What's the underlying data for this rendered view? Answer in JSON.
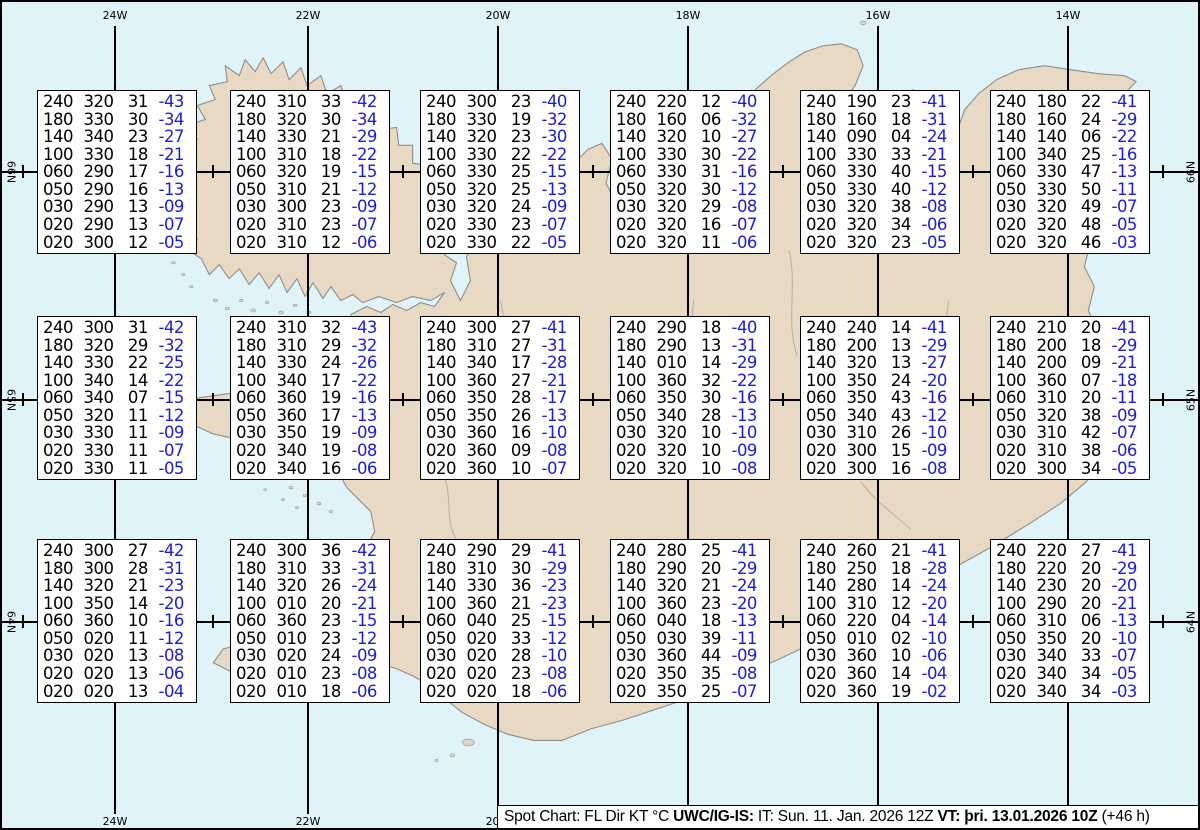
{
  "graticule": {
    "meridians": [
      {
        "label": "24W",
        "x": 113
      },
      {
        "label": "22W",
        "x": 306
      },
      {
        "label": "20W",
        "x": 496
      },
      {
        "label": "18W",
        "x": 686
      },
      {
        "label": "16W",
        "x": 876
      },
      {
        "label": "14W",
        "x": 1066
      }
    ],
    "parallels": [
      {
        "label": "66N",
        "y": 170
      },
      {
        "label": "65N",
        "y": 398
      },
      {
        "label": "64N",
        "y": 620
      }
    ],
    "minor_tick_x": [
      21,
      211,
      401,
      591,
      781,
      971,
      1161
    ]
  },
  "colors": {
    "ocean": "#dff3f8",
    "land": "#e8d9c5",
    "coastline": "#8e8e88",
    "temperature_text": "#1c1cdb",
    "graticule": "#000000"
  },
  "boxes": [
    {
      "row": 0,
      "col": 0,
      "lines": [
        [
          "240",
          "320",
          "31",
          "-43"
        ],
        [
          "180",
          "330",
          "30",
          "-34"
        ],
        [
          "140",
          "340",
          "23",
          "-27"
        ],
        [
          "100",
          "330",
          "18",
          "-21"
        ],
        [
          "060",
          "290",
          "17",
          "-16"
        ],
        [
          "050",
          "290",
          "16",
          "-13"
        ],
        [
          "030",
          "290",
          "13",
          "-09"
        ],
        [
          "020",
          "290",
          "13",
          "-07"
        ],
        [
          "020",
          "300",
          "12",
          "-05"
        ]
      ]
    },
    {
      "row": 0,
      "col": 1,
      "lines": [
        [
          "240",
          "310",
          "33",
          "-42"
        ],
        [
          "180",
          "320",
          "30",
          "-34"
        ],
        [
          "140",
          "330",
          "21",
          "-29"
        ],
        [
          "100",
          "310",
          "18",
          "-22"
        ],
        [
          "060",
          "320",
          "19",
          "-15"
        ],
        [
          "050",
          "310",
          "21",
          "-12"
        ],
        [
          "030",
          "300",
          "23",
          "-09"
        ],
        [
          "020",
          "310",
          "23",
          "-07"
        ],
        [
          "020",
          "310",
          "12",
          "-06"
        ]
      ]
    },
    {
      "row": 0,
      "col": 2,
      "lines": [
        [
          "240",
          "300",
          "23",
          "-40"
        ],
        [
          "180",
          "330",
          "19",
          "-32"
        ],
        [
          "140",
          "320",
          "23",
          "-30"
        ],
        [
          "100",
          "330",
          "22",
          "-22"
        ],
        [
          "060",
          "330",
          "25",
          "-15"
        ],
        [
          "050",
          "320",
          "25",
          "-13"
        ],
        [
          "030",
          "320",
          "24",
          "-09"
        ],
        [
          "020",
          "330",
          "23",
          "-07"
        ],
        [
          "020",
          "330",
          "22",
          "-05"
        ]
      ]
    },
    {
      "row": 0,
      "col": 3,
      "lines": [
        [
          "240",
          "220",
          "12",
          "-40"
        ],
        [
          "180",
          "160",
          "06",
          "-32"
        ],
        [
          "140",
          "320",
          "10",
          "-27"
        ],
        [
          "100",
          "330",
          "30",
          "-22"
        ],
        [
          "060",
          "330",
          "31",
          "-16"
        ],
        [
          "050",
          "320",
          "30",
          "-12"
        ],
        [
          "030",
          "320",
          "29",
          "-08"
        ],
        [
          "020",
          "320",
          "16",
          "-07"
        ],
        [
          "020",
          "320",
          "11",
          "-06"
        ]
      ]
    },
    {
      "row": 0,
      "col": 4,
      "lines": [
        [
          "240",
          "190",
          "23",
          "-41"
        ],
        [
          "180",
          "160",
          "18",
          "-31"
        ],
        [
          "140",
          "090",
          "04",
          "-24"
        ],
        [
          "100",
          "330",
          "33",
          "-21"
        ],
        [
          "060",
          "330",
          "40",
          "-15"
        ],
        [
          "050",
          "330",
          "40",
          "-12"
        ],
        [
          "030",
          "320",
          "38",
          "-08"
        ],
        [
          "020",
          "320",
          "34",
          "-06"
        ],
        [
          "020",
          "320",
          "23",
          "-05"
        ]
      ]
    },
    {
      "row": 0,
      "col": 5,
      "lines": [
        [
          "240",
          "180",
          "22",
          "-41"
        ],
        [
          "180",
          "160",
          "24",
          "-29"
        ],
        [
          "140",
          "140",
          "06",
          "-22"
        ],
        [
          "100",
          "340",
          "25",
          "-16"
        ],
        [
          "060",
          "330",
          "47",
          "-13"
        ],
        [
          "050",
          "330",
          "50",
          "-11"
        ],
        [
          "030",
          "320",
          "49",
          "-07"
        ],
        [
          "020",
          "320",
          "48",
          "-05"
        ],
        [
          "020",
          "320",
          "46",
          "-03"
        ]
      ]
    },
    {
      "row": 1,
      "col": 0,
      "lines": [
        [
          "240",
          "300",
          "31",
          "-42"
        ],
        [
          "180",
          "320",
          "29",
          "-32"
        ],
        [
          "140",
          "330",
          "22",
          "-25"
        ],
        [
          "100",
          "340",
          "14",
          "-22"
        ],
        [
          "060",
          "340",
          "07",
          "-15"
        ],
        [
          "050",
          "320",
          "11",
          "-12"
        ],
        [
          "030",
          "330",
          "11",
          "-09"
        ],
        [
          "020",
          "330",
          "11",
          "-07"
        ],
        [
          "020",
          "330",
          "11",
          "-05"
        ]
      ]
    },
    {
      "row": 1,
      "col": 1,
      "lines": [
        [
          "240",
          "310",
          "32",
          "-43"
        ],
        [
          "180",
          "310",
          "29",
          "-32"
        ],
        [
          "140",
          "330",
          "24",
          "-26"
        ],
        [
          "100",
          "340",
          "17",
          "-22"
        ],
        [
          "060",
          "360",
          "19",
          "-16"
        ],
        [
          "050",
          "360",
          "17",
          "-13"
        ],
        [
          "030",
          "350",
          "19",
          "-09"
        ],
        [
          "020",
          "340",
          "19",
          "-08"
        ],
        [
          "020",
          "340",
          "16",
          "-06"
        ]
      ]
    },
    {
      "row": 1,
      "col": 2,
      "lines": [
        [
          "240",
          "300",
          "27",
          "-41"
        ],
        [
          "180",
          "310",
          "27",
          "-31"
        ],
        [
          "140",
          "340",
          "17",
          "-28"
        ],
        [
          "100",
          "360",
          "27",
          "-21"
        ],
        [
          "060",
          "350",
          "28",
          "-17"
        ],
        [
          "050",
          "350",
          "26",
          "-13"
        ],
        [
          "030",
          "360",
          "16",
          "-10"
        ],
        [
          "020",
          "360",
          "09",
          "-08"
        ],
        [
          "020",
          "360",
          "10",
          "-07"
        ]
      ]
    },
    {
      "row": 1,
      "col": 3,
      "lines": [
        [
          "240",
          "290",
          "18",
          "-40"
        ],
        [
          "180",
          "290",
          "13",
          "-31"
        ],
        [
          "140",
          "010",
          "14",
          "-29"
        ],
        [
          "100",
          "360",
          "32",
          "-22"
        ],
        [
          "060",
          "350",
          "30",
          "-16"
        ],
        [
          "050",
          "340",
          "28",
          "-13"
        ],
        [
          "030",
          "320",
          "10",
          "-10"
        ],
        [
          "020",
          "320",
          "10",
          "-09"
        ],
        [
          "020",
          "320",
          "10",
          "-08"
        ]
      ]
    },
    {
      "row": 1,
      "col": 4,
      "lines": [
        [
          "240",
          "240",
          "14",
          "-41"
        ],
        [
          "180",
          "200",
          "13",
          "-29"
        ],
        [
          "140",
          "320",
          "13",
          "-27"
        ],
        [
          "100",
          "350",
          "24",
          "-20"
        ],
        [
          "060",
          "350",
          "43",
          "-16"
        ],
        [
          "050",
          "340",
          "43",
          "-12"
        ],
        [
          "030",
          "310",
          "26",
          "-10"
        ],
        [
          "020",
          "300",
          "15",
          "-09"
        ],
        [
          "020",
          "300",
          "16",
          "-08"
        ]
      ]
    },
    {
      "row": 1,
      "col": 5,
      "lines": [
        [
          "240",
          "210",
          "20",
          "-41"
        ],
        [
          "180",
          "200",
          "18",
          "-29"
        ],
        [
          "140",
          "200",
          "09",
          "-21"
        ],
        [
          "100",
          "360",
          "07",
          "-18"
        ],
        [
          "060",
          "310",
          "20",
          "-11"
        ],
        [
          "050",
          "320",
          "38",
          "-09"
        ],
        [
          "030",
          "310",
          "42",
          "-07"
        ],
        [
          "020",
          "310",
          "38",
          "-06"
        ],
        [
          "020",
          "300",
          "34",
          "-05"
        ]
      ]
    },
    {
      "row": 2,
      "col": 0,
      "lines": [
        [
          "240",
          "300",
          "27",
          "-42"
        ],
        [
          "180",
          "300",
          "28",
          "-31"
        ],
        [
          "140",
          "320",
          "21",
          "-23"
        ],
        [
          "100",
          "350",
          "14",
          "-20"
        ],
        [
          "060",
          "360",
          "10",
          "-16"
        ],
        [
          "050",
          "020",
          "11",
          "-12"
        ],
        [
          "030",
          "020",
          "13",
          "-08"
        ],
        [
          "020",
          "020",
          "13",
          "-06"
        ],
        [
          "020",
          "020",
          "13",
          "-04"
        ]
      ]
    },
    {
      "row": 2,
      "col": 1,
      "lines": [
        [
          "240",
          "300",
          "36",
          "-42"
        ],
        [
          "180",
          "310",
          "33",
          "-31"
        ],
        [
          "140",
          "320",
          "26",
          "-24"
        ],
        [
          "100",
          "010",
          "20",
          "-21"
        ],
        [
          "060",
          "360",
          "23",
          "-15"
        ],
        [
          "050",
          "010",
          "23",
          "-12"
        ],
        [
          "030",
          "020",
          "24",
          "-09"
        ],
        [
          "020",
          "010",
          "23",
          "-08"
        ],
        [
          "020",
          "010",
          "18",
          "-06"
        ]
      ]
    },
    {
      "row": 2,
      "col": 2,
      "lines": [
        [
          "240",
          "290",
          "29",
          "-41"
        ],
        [
          "180",
          "310",
          "30",
          "-29"
        ],
        [
          "140",
          "330",
          "36",
          "-23"
        ],
        [
          "100",
          "360",
          "21",
          "-23"
        ],
        [
          "060",
          "040",
          "25",
          "-15"
        ],
        [
          "050",
          "020",
          "33",
          "-12"
        ],
        [
          "030",
          "020",
          "28",
          "-10"
        ],
        [
          "020",
          "020",
          "23",
          "-08"
        ],
        [
          "020",
          "020",
          "18",
          "-06"
        ]
      ]
    },
    {
      "row": 2,
      "col": 3,
      "lines": [
        [
          "240",
          "280",
          "25",
          "-41"
        ],
        [
          "180",
          "290",
          "20",
          "-29"
        ],
        [
          "140",
          "320",
          "21",
          "-24"
        ],
        [
          "100",
          "360",
          "23",
          "-20"
        ],
        [
          "060",
          "040",
          "18",
          "-13"
        ],
        [
          "050",
          "030",
          "39",
          "-11"
        ],
        [
          "030",
          "360",
          "44",
          "-09"
        ],
        [
          "020",
          "350",
          "35",
          "-08"
        ],
        [
          "020",
          "350",
          "25",
          "-07"
        ]
      ]
    },
    {
      "row": 2,
      "col": 4,
      "lines": [
        [
          "240",
          "260",
          "21",
          "-41"
        ],
        [
          "180",
          "250",
          "18",
          "-28"
        ],
        [
          "140",
          "280",
          "14",
          "-24"
        ],
        [
          "100",
          "310",
          "12",
          "-20"
        ],
        [
          "060",
          "220",
          "04",
          "-14"
        ],
        [
          "050",
          "010",
          "02",
          "-10"
        ],
        [
          "030",
          "360",
          "10",
          "-06"
        ],
        [
          "020",
          "360",
          "14",
          "-04"
        ],
        [
          "020",
          "360",
          "19",
          "-02"
        ]
      ]
    },
    {
      "row": 2,
      "col": 5,
      "lines": [
        [
          "240",
          "220",
          "27",
          "-41"
        ],
        [
          "180",
          "220",
          "20",
          "-29"
        ],
        [
          "140",
          "230",
          "20",
          "-20"
        ],
        [
          "100",
          "290",
          "20",
          "-21"
        ],
        [
          "060",
          "310",
          "06",
          "-13"
        ],
        [
          "050",
          "350",
          "20",
          "-10"
        ],
        [
          "030",
          "340",
          "33",
          "-07"
        ],
        [
          "020",
          "340",
          "34",
          "-05"
        ],
        [
          "020",
          "340",
          "34",
          "-03"
        ]
      ]
    }
  ],
  "status_bar": {
    "title_text": "Spot Chart: FL Dir KT °C ",
    "source_bold": "UWC/IG-IS:",
    "issue_text": " IT: Sun. 11. Jan. 2026 12Z ",
    "valid_bold": "VT: þri. 13.01.2026 10Z",
    "suffix_text": " (+46 h)"
  }
}
